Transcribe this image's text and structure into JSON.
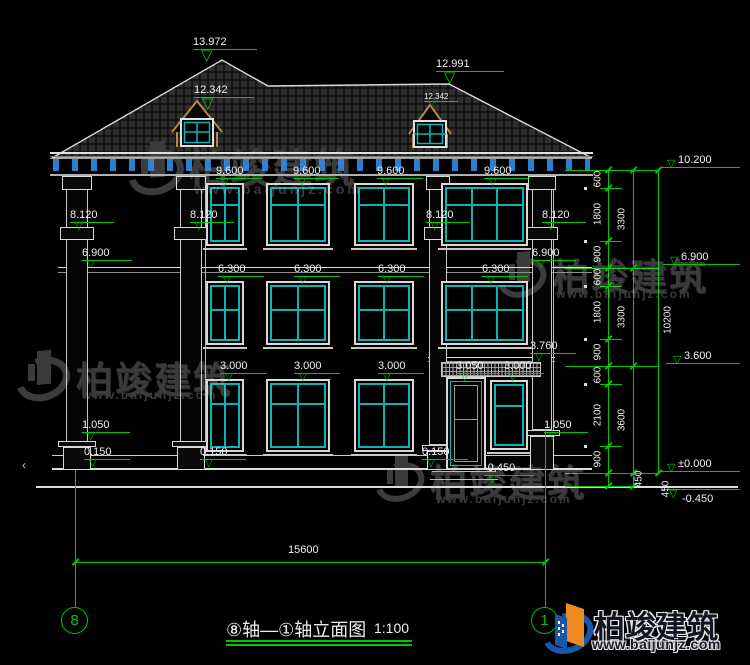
{
  "drawing": {
    "title": "⑧轴—①轴立面图",
    "scale": "1:100",
    "axis": {
      "left": "8",
      "right": "1",
      "span": "15600"
    }
  },
  "levels": {
    "roof": [
      "13.972",
      "12.342",
      "12.991",
      "12.342"
    ],
    "row_9600": [
      "9.600",
      "9.600",
      "9.600",
      "9.600"
    ],
    "row_8120": [
      "8.120",
      "8.120",
      "8.120",
      "8.120"
    ],
    "row_6900": [
      "6.900",
      "6.900"
    ],
    "row_6300": [
      "6.300",
      "6.300",
      "6.300",
      "6.300"
    ],
    "mark_3760": "3.760",
    "row_3000": [
      "3.000",
      "3.000",
      "3.000",
      "3.050",
      "3.000"
    ],
    "row_1050": [
      "1.050",
      "1.050"
    ],
    "row_0150": [
      "0.150",
      "0.150",
      "0.150"
    ],
    "mark_m0450": "-0.450"
  },
  "right_levels": [
    "10.200",
    "6.900",
    "3.600",
    "±0.000",
    "-0.450"
  ],
  "dims": {
    "inner": [
      "600",
      "1800",
      "900",
      "600",
      "1800",
      "900",
      "600",
      "2100",
      "900",
      "450"
    ],
    "middle": [
      "3300",
      "3300",
      "3600",
      "450"
    ],
    "overall": "10200"
  },
  "watermark": {
    "brand": "柏竣建筑",
    "url": "www.baijunjz.com"
  },
  "logo": {
    "brand": "柏竣建筑",
    "url": "www.baijunjz.com"
  }
}
